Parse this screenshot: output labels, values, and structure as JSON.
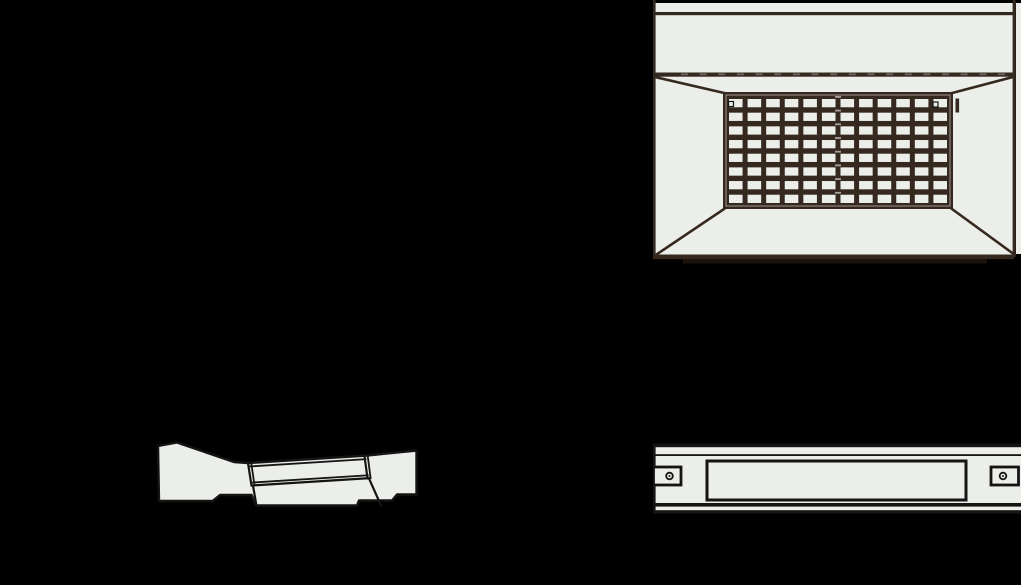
{
  "canvas": {
    "width": 1021,
    "height": 585,
    "background": "#000000"
  },
  "palette": {
    "panel_fill": "#ECEEE9",
    "line_dark": "#35281F",
    "line_black": "#141414",
    "tick_light": "#6E655D",
    "dash_light": "#A9A29A",
    "foot_dark": "#1C130C"
  },
  "views": {
    "front": {
      "name": "enclosure-front-view",
      "grille": {
        "rows": 8,
        "cols": 12,
        "center_dash_count": 8,
        "screw_count": 2
      },
      "edge_tick_count": 18
    },
    "perspective": {
      "name": "enclosure-perspective-view"
    },
    "side": {
      "name": "enclosure-side-view",
      "mounting_tab_count": 2,
      "screw_hole_count": 2
    }
  }
}
